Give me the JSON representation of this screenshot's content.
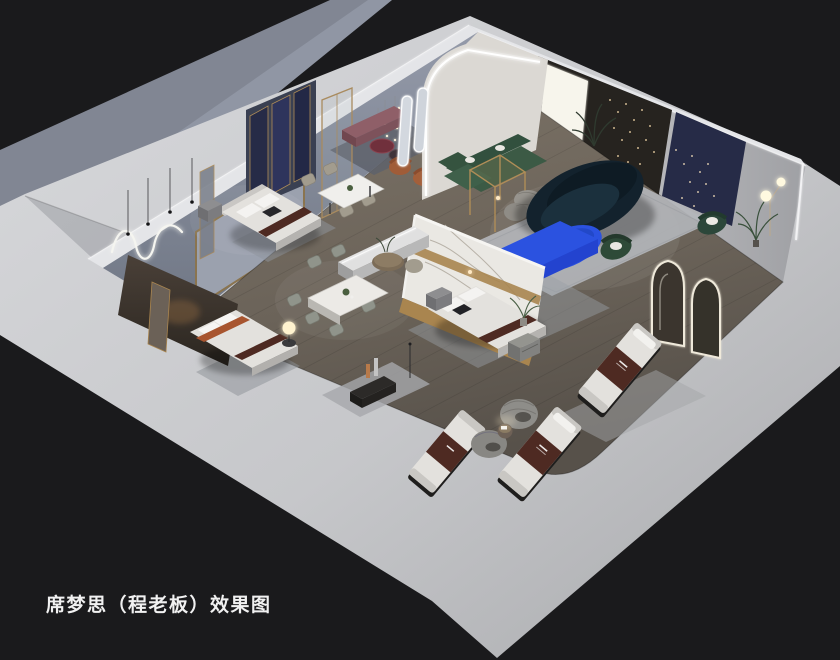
{
  "caption": {
    "text": "席梦思（程老板）效果图"
  },
  "palette": {
    "background": "#1a1a1c",
    "backdrop_wall": "#9096a4",
    "exterior_wall_light": "#d6d7da",
    "exterior_wall_dark": "#aaabae",
    "interior_back_wall": "#8b91a0",
    "wall_top_light": "#e4e5e8",
    "floor_wood": "#6e665c",
    "mattress_white": "#e3e1dd",
    "brand_runner_brown": "#4e2a22",
    "accent_blue": "#2b52e0",
    "accent_blue_dark": "#1c35b8",
    "sofa_teal": "#13222d",
    "sofa_green": "#3c5a45",
    "bench_mauve": "#8f5f68",
    "chair_rust": "#a05c38",
    "panel_navy": "#262b47",
    "marble_white": "#eae8e3",
    "trim_gold": "#a9854f",
    "rug_gray": "#b4b6ba",
    "led_white": "#ffffff"
  },
  "scene": {
    "label": "isometric-cutaway-render-of-mattress-showroom",
    "areas": [
      {
        "id": "bedroom-navy-panels",
        "items": [
          "upholstered-bed",
          "navy-wall-panels",
          "nightstand",
          "pendant-lights",
          "wavy-neon-wall-light"
        ]
      },
      {
        "id": "bedroom-marble-wall",
        "items": [
          "upholstered-bed",
          "marble-feature-wall",
          "gold-trim-band",
          "nightstands",
          "area-rug"
        ]
      },
      {
        "id": "bedroom-accent",
        "items": [
          "upholstered-bed",
          "dark-wood-partition",
          "glowing-orb-lamp"
        ]
      },
      {
        "id": "dining-display-small",
        "items": [
          "marble-dining-table",
          "four-chairs",
          "plant-centerpiece",
          "cluster-chandelier"
        ]
      },
      {
        "id": "dining-display-large",
        "items": [
          "marble-dining-table",
          "six-chairs",
          "plant-centerpiece",
          "led-console-bench"
        ]
      },
      {
        "id": "lounge",
        "items": [
          "curved-teal-sofa",
          "blue-oval-coffee-table",
          "blue-media-console",
          "green-sectional-sofa",
          "green-accent-chair",
          "gray-knit-poufs",
          "area-rug",
          "globe-floor-lamp",
          "arched-led-portal",
          "backlit-art-wall",
          "string-lights",
          "mauve-bench",
          "rust-armchairs",
          "burgundy-side-tables",
          "pill-led-mirrors"
        ]
      },
      {
        "id": "mattress-gallery",
        "items": [
          "branded-mattress-display-1",
          "branded-mattress-display-2",
          "branded-mattress-display-3",
          "swivel-lounge-chairs",
          "round-side-table",
          "arched-led-mirrors",
          "green-armchair",
          "palm-plant"
        ]
      }
    ]
  }
}
